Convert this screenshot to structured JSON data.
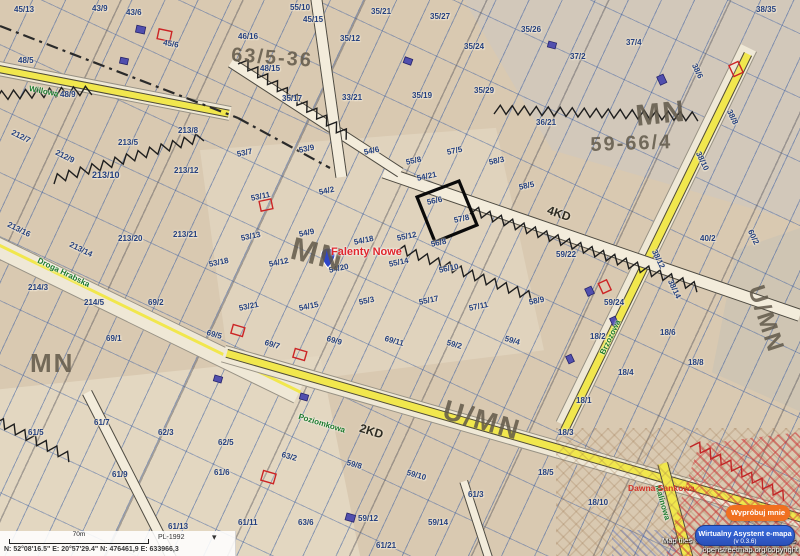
{
  "statusbar": {
    "scale_label": "70m",
    "crs": "PL-1992",
    "coords": "N: 52°08'16.5\"   E: 20°57'29.4\"   N: 476461,9   E: 633966,3"
  },
  "attribution": {
    "line1": "Map tiles © OpenStreetMap contributors,",
    "line2": "openstreetmap.org/copyright"
  },
  "assistant": {
    "bubble": "Wypróbuj mnie",
    "title": "Wirtualny Asystent e-mapa",
    "version": "(v 0.3.6)"
  },
  "map": {
    "place_label": "Falenty Nowe",
    "zone_labels": [
      {
        "t": "MN",
        "x": 30,
        "y": 348,
        "s": 26,
        "r": 0
      },
      {
        "t": "MN",
        "x": 634,
        "y": 100,
        "s": 30,
        "r": -6
      },
      {
        "t": "59-66/4",
        "x": 590,
        "y": 134,
        "s": 20,
        "r": -2
      },
      {
        "t": "MN",
        "x": 296,
        "y": 230,
        "s": 32,
        "r": 14
      },
      {
        "t": "U/MN",
        "x": 448,
        "y": 394,
        "s": 28,
        "r": 16
      },
      {
        "t": "U/MN",
        "x": 768,
        "y": 282,
        "s": 24,
        "r": 72
      },
      {
        "t": "63/5-36",
        "x": 232,
        "y": 44,
        "s": 20,
        "r": 4
      }
    ],
    "road_labels": [
      {
        "t": "4KD",
        "x": 550,
        "y": 203,
        "r": 19
      },
      {
        "t": "2KD",
        "x": 362,
        "y": 421,
        "r": 17
      }
    ],
    "street_names": [
      {
        "t": "Droga Hrabska",
        "x": 40,
        "y": 256,
        "r": 26
      },
      {
        "t": "Willowa",
        "x": 30,
        "y": 84,
        "r": 11
      },
      {
        "t": "Poziomkowa",
        "x": 300,
        "y": 412,
        "r": 17
      },
      {
        "t": "Brzozowa",
        "x": 598,
        "y": 352,
        "r": -64
      },
      {
        "t": "Malinowa",
        "x": 662,
        "y": 484,
        "r": 74
      }
    ],
    "note_labels": [
      {
        "t": "Dawna Sankowa",
        "x": 628,
        "y": 483
      }
    ],
    "parcel_labels": [
      {
        "t": "45/13",
        "x": 14,
        "y": 5,
        "r": 0
      },
      {
        "t": "43/9",
        "x": 92,
        "y": 4,
        "r": 0
      },
      {
        "t": "43/6",
        "x": 126,
        "y": 8,
        "r": 0
      },
      {
        "t": "45/6",
        "x": 164,
        "y": 38,
        "r": 10
      },
      {
        "t": "46/16",
        "x": 238,
        "y": 32,
        "r": 0
      },
      {
        "t": "55/10",
        "x": 290,
        "y": 3,
        "r": 0
      },
      {
        "t": "45/15",
        "x": 303,
        "y": 15,
        "r": 0
      },
      {
        "t": "35/12",
        "x": 340,
        "y": 34,
        "r": 0
      },
      {
        "t": "35/21",
        "x": 371,
        "y": 7,
        "r": 0
      },
      {
        "t": "35/27",
        "x": 430,
        "y": 12,
        "r": 0
      },
      {
        "t": "35/24",
        "x": 464,
        "y": 42,
        "r": 0
      },
      {
        "t": "35/26",
        "x": 521,
        "y": 25,
        "r": 0
      },
      {
        "t": "37/2",
        "x": 570,
        "y": 52,
        "r": 0
      },
      {
        "t": "37/4",
        "x": 626,
        "y": 38,
        "r": 0
      },
      {
        "t": "38/35",
        "x": 756,
        "y": 5,
        "r": 0
      },
      {
        "t": "38/6",
        "x": 698,
        "y": 62,
        "r": 64
      },
      {
        "t": "38/8",
        "x": 733,
        "y": 108,
        "r": 64
      },
      {
        "t": "38/10",
        "x": 702,
        "y": 150,
        "r": 64
      },
      {
        "t": "60/2",
        "x": 754,
        "y": 228,
        "r": 64
      },
      {
        "t": "48/5",
        "x": 18,
        "y": 56,
        "r": 0
      },
      {
        "t": "48/9",
        "x": 60,
        "y": 90,
        "r": 0
      },
      {
        "t": "48/15",
        "x": 260,
        "y": 64,
        "r": 0
      },
      {
        "t": "35/17",
        "x": 282,
        "y": 94,
        "r": 0
      },
      {
        "t": "33/21",
        "x": 342,
        "y": 93,
        "r": 0
      },
      {
        "t": "35/19",
        "x": 412,
        "y": 91,
        "r": 0
      },
      {
        "t": "35/29",
        "x": 474,
        "y": 86,
        "r": 0
      },
      {
        "t": "36/21",
        "x": 536,
        "y": 118,
        "r": 0
      },
      {
        "t": "212/7",
        "x": 14,
        "y": 128,
        "r": 26
      },
      {
        "t": "212/9",
        "x": 58,
        "y": 148,
        "r": 26
      },
      {
        "t": "213/5",
        "x": 118,
        "y": 138,
        "r": 0
      },
      {
        "t": "213/8",
        "x": 178,
        "y": 126,
        "r": 0
      },
      {
        "t": "213/10",
        "x": 92,
        "y": 170,
        "r": 0,
        "s": 9
      },
      {
        "t": "213/12",
        "x": 174,
        "y": 166,
        "r": 0
      },
      {
        "t": "213/16",
        "x": 10,
        "y": 220,
        "r": 26
      },
      {
        "t": "213/14",
        "x": 72,
        "y": 240,
        "r": 26
      },
      {
        "t": "213/20",
        "x": 118,
        "y": 234,
        "r": 0
      },
      {
        "t": "213/21",
        "x": 173,
        "y": 230,
        "r": 0
      },
      {
        "t": "214/3",
        "x": 28,
        "y": 283,
        "r": 0
      },
      {
        "t": "214/5",
        "x": 84,
        "y": 298,
        "r": 0
      },
      {
        "t": "69/2",
        "x": 148,
        "y": 298,
        "r": 0
      },
      {
        "t": "69/1",
        "x": 106,
        "y": 334,
        "r": 0
      },
      {
        "t": "53/7",
        "x": 236,
        "y": 150,
        "r": -12
      },
      {
        "t": "53/9",
        "x": 298,
        "y": 146,
        "r": -12
      },
      {
        "t": "53/11",
        "x": 250,
        "y": 194,
        "r": -12
      },
      {
        "t": "54/2",
        "x": 318,
        "y": 188,
        "r": -12
      },
      {
        "t": "54/6",
        "x": 363,
        "y": 148,
        "r": -12
      },
      {
        "t": "55/8",
        "x": 405,
        "y": 158,
        "r": -12
      },
      {
        "t": "57/5",
        "x": 446,
        "y": 148,
        "r": -12
      },
      {
        "t": "54/21",
        "x": 416,
        "y": 174,
        "r": -12
      },
      {
        "t": "56/6",
        "x": 426,
        "y": 198,
        "r": -12
      },
      {
        "t": "57/8",
        "x": 453,
        "y": 216,
        "r": -12
      },
      {
        "t": "58/3",
        "x": 488,
        "y": 158,
        "r": -12
      },
      {
        "t": "58/5",
        "x": 518,
        "y": 183,
        "r": -12
      },
      {
        "t": "53/13",
        "x": 240,
        "y": 234,
        "r": -12
      },
      {
        "t": "54/9",
        "x": 298,
        "y": 230,
        "r": -12
      },
      {
        "t": "54/18",
        "x": 353,
        "y": 238,
        "r": -12
      },
      {
        "t": "55/12",
        "x": 396,
        "y": 234,
        "r": -12
      },
      {
        "t": "56/8",
        "x": 430,
        "y": 240,
        "r": -12
      },
      {
        "t": "53/18",
        "x": 208,
        "y": 260,
        "r": -12
      },
      {
        "t": "54/12",
        "x": 268,
        "y": 260,
        "r": -12
      },
      {
        "t": "54/20",
        "x": 328,
        "y": 266,
        "r": -12
      },
      {
        "t": "55/14",
        "x": 388,
        "y": 260,
        "r": -12
      },
      {
        "t": "56/10",
        "x": 438,
        "y": 266,
        "r": -12
      },
      {
        "t": "53/21",
        "x": 238,
        "y": 304,
        "r": -12
      },
      {
        "t": "54/15",
        "x": 298,
        "y": 304,
        "r": -12
      },
      {
        "t": "55/3",
        "x": 358,
        "y": 298,
        "r": -12
      },
      {
        "t": "55/17",
        "x": 418,
        "y": 298,
        "r": -12
      },
      {
        "t": "57/11",
        "x": 468,
        "y": 304,
        "r": -12
      },
      {
        "t": "58/9",
        "x": 528,
        "y": 298,
        "r": -12
      },
      {
        "t": "59/22",
        "x": 556,
        "y": 250,
        "r": 0
      },
      {
        "t": "59/24",
        "x": 604,
        "y": 298,
        "r": 0
      },
      {
        "t": "38/12",
        "x": 658,
        "y": 248,
        "r": 64
      },
      {
        "t": "38/14",
        "x": 674,
        "y": 278,
        "r": 64
      },
      {
        "t": "40/2",
        "x": 700,
        "y": 234,
        "r": 0
      },
      {
        "t": "69/5",
        "x": 208,
        "y": 328,
        "r": 16
      },
      {
        "t": "69/7",
        "x": 266,
        "y": 338,
        "r": 16
      },
      {
        "t": "69/9",
        "x": 328,
        "y": 334,
        "r": 16
      },
      {
        "t": "69/11",
        "x": 386,
        "y": 334,
        "r": 16
      },
      {
        "t": "59/2",
        "x": 448,
        "y": 338,
        "r": 16
      },
      {
        "t": "59/4",
        "x": 506,
        "y": 334,
        "r": 16
      },
      {
        "t": "18/2",
        "x": 590,
        "y": 332,
        "r": 0
      },
      {
        "t": "18/4",
        "x": 618,
        "y": 368,
        "r": 0
      },
      {
        "t": "18/6",
        "x": 660,
        "y": 328,
        "r": 0
      },
      {
        "t": "18/8",
        "x": 688,
        "y": 358,
        "r": 0
      },
      {
        "t": "18/1",
        "x": 576,
        "y": 396,
        "r": 0
      },
      {
        "t": "18/3",
        "x": 558,
        "y": 428,
        "r": 0
      },
      {
        "t": "18/5",
        "x": 538,
        "y": 468,
        "r": 0
      },
      {
        "t": "61/5",
        "x": 28,
        "y": 428,
        "r": 0
      },
      {
        "t": "61/7",
        "x": 94,
        "y": 418,
        "r": 0
      },
      {
        "t": "62/3",
        "x": 158,
        "y": 428,
        "r": 0
      },
      {
        "t": "62/5",
        "x": 218,
        "y": 438,
        "r": 0
      },
      {
        "t": "61/9",
        "x": 112,
        "y": 470,
        "r": 0
      },
      {
        "t": "61/6",
        "x": 214,
        "y": 468,
        "r": 0
      },
      {
        "t": "63/2",
        "x": 283,
        "y": 450,
        "r": 16
      },
      {
        "t": "59/8",
        "x": 348,
        "y": 458,
        "r": 16
      },
      {
        "t": "59/10",
        "x": 408,
        "y": 468,
        "r": 16
      },
      {
        "t": "61/3",
        "x": 468,
        "y": 490,
        "r": 0
      },
      {
        "t": "59/12",
        "x": 358,
        "y": 514,
        "r": 0
      },
      {
        "t": "59/14",
        "x": 428,
        "y": 518,
        "r": 0
      },
      {
        "t": "63/6",
        "x": 298,
        "y": 518,
        "r": 0
      },
      {
        "t": "61/11",
        "x": 238,
        "y": 518,
        "r": 0
      },
      {
        "t": "61/13",
        "x": 168,
        "y": 522,
        "r": 0
      },
      {
        "t": "61/21",
        "x": 376,
        "y": 541,
        "r": 0
      },
      {
        "t": "18/10",
        "x": 588,
        "y": 498,
        "r": 0
      }
    ]
  }
}
